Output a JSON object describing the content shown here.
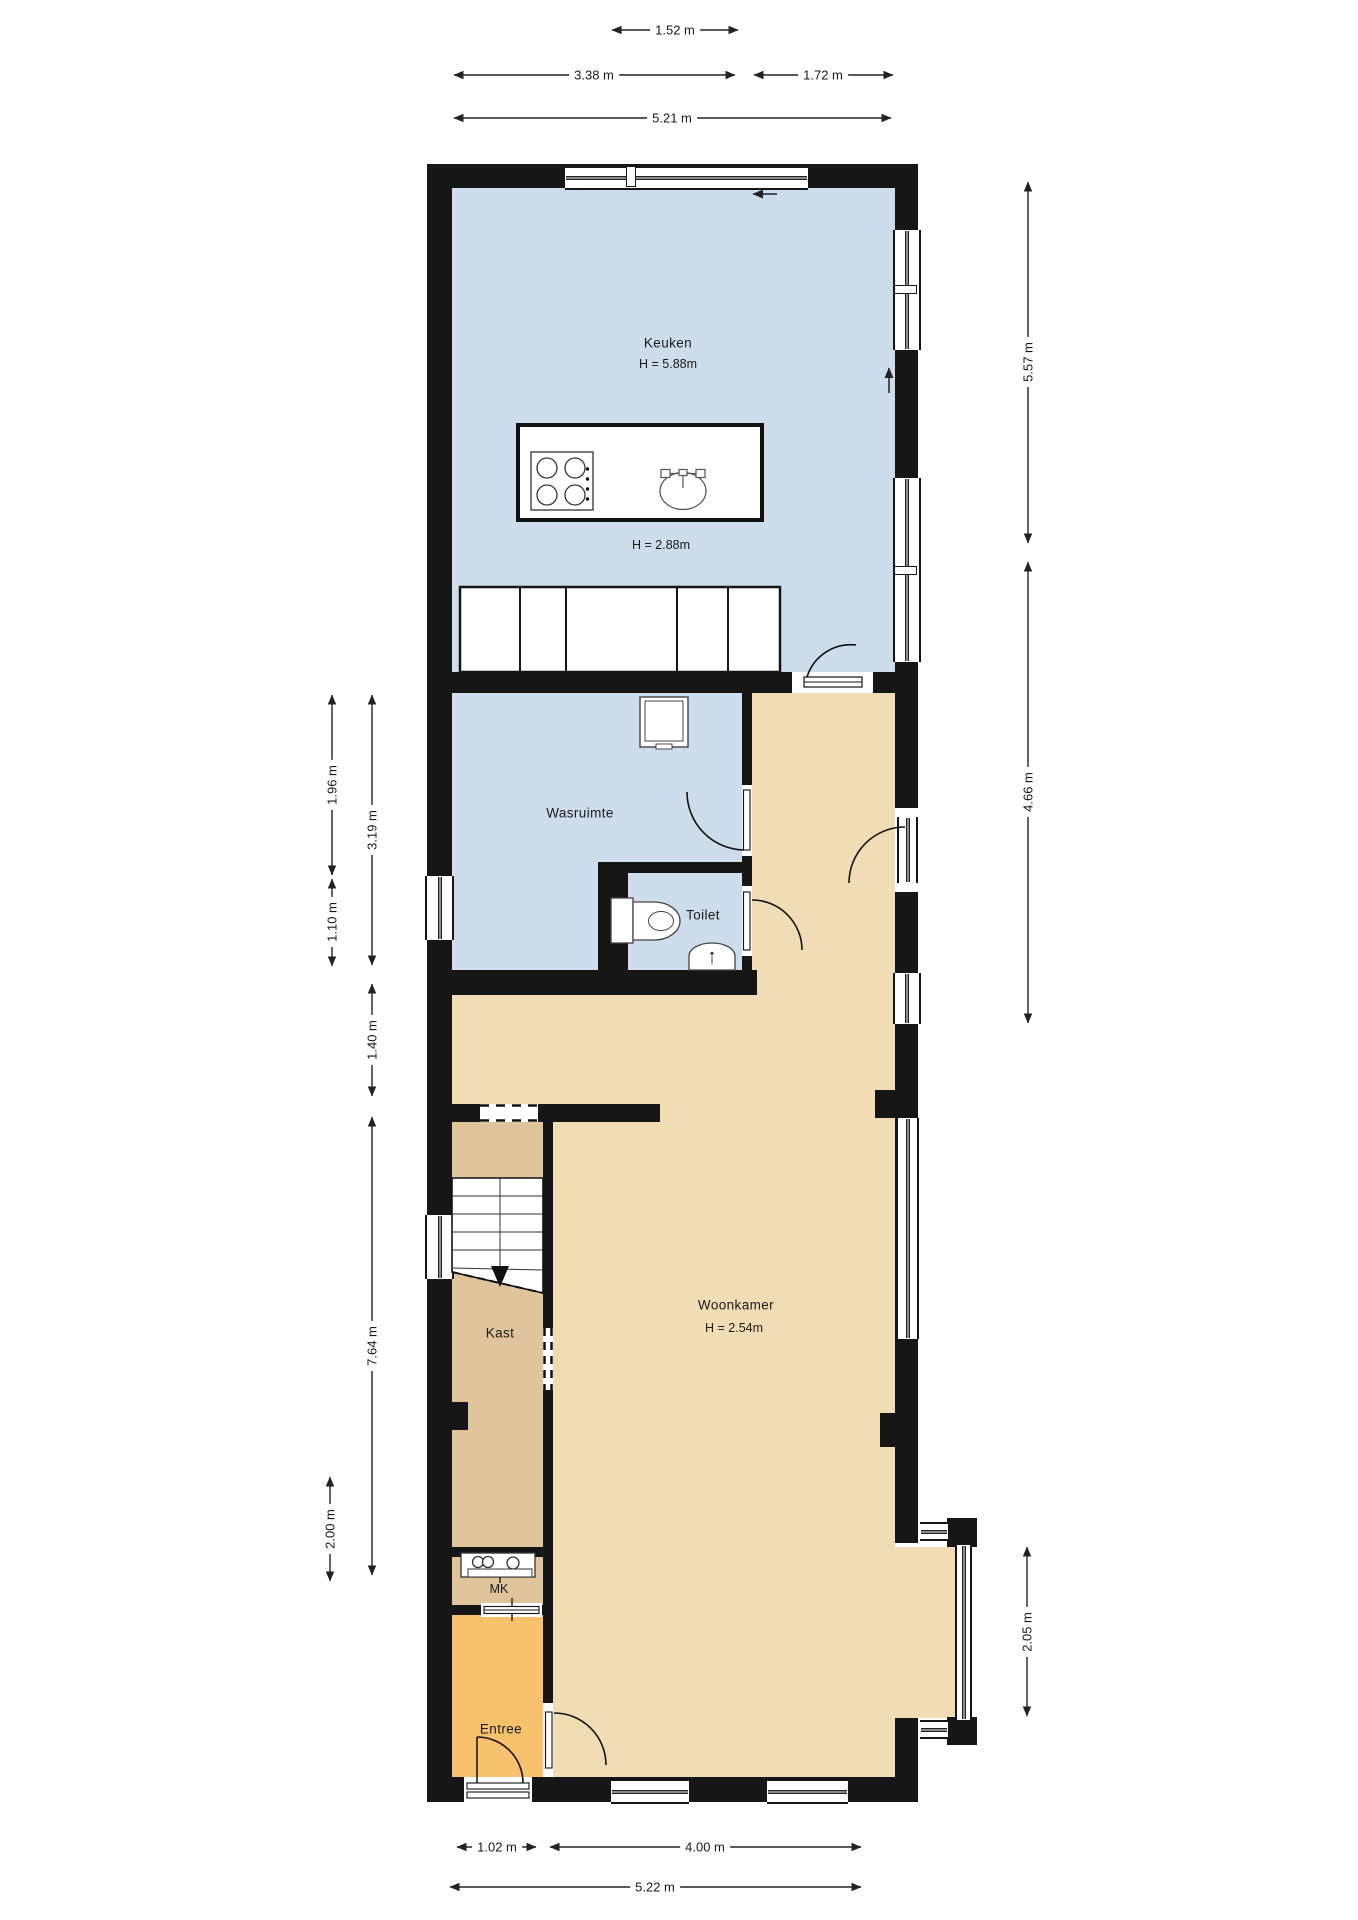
{
  "rooms": {
    "keuken": {
      "label": "Keuken",
      "height_label": "H = 5.88m",
      "height_label_2": "H = 2.88m"
    },
    "wasruimte": {
      "label": "Wasruimte"
    },
    "toilet": {
      "label": "Toilet"
    },
    "woonkamer": {
      "label": "Woonkamer",
      "height_label": "H = 2.54m"
    },
    "kast": {
      "label": "Kast"
    },
    "meterkast": {
      "label": "MK"
    },
    "entree": {
      "label": "Entree"
    }
  },
  "dimensions": {
    "top": [
      {
        "label": "1.52 m"
      },
      {
        "label": "3.38 m"
      },
      {
        "label": "1.72 m"
      },
      {
        "label": "5.21 m"
      }
    ],
    "bottom": [
      {
        "label": "1.02 m"
      },
      {
        "label": "4.00 m"
      },
      {
        "label": "5.22 m"
      }
    ],
    "left": [
      {
        "label": "1.96 m"
      },
      {
        "label": "1.10 m"
      },
      {
        "label": "3.19 m"
      },
      {
        "label": "1.40 m"
      },
      {
        "label": "7.64 m"
      },
      {
        "label": "2.00 m"
      }
    ],
    "right": [
      {
        "label": "5.57 m"
      },
      {
        "label": "4.66 m"
      },
      {
        "label": "2.05 m"
      }
    ]
  },
  "icons": {
    "cooktop": "cooktop-icon",
    "sink": "sink-icon",
    "washing_machine": "washing-machine-icon",
    "toilet": "toilet-icon",
    "hand_basin": "hand-basin-icon",
    "stairs": "stairs-down-icon",
    "meter_board": "meter-board-icon",
    "slide_arrow_left": "slide-arrow-left-icon",
    "slide_arrow_up": "slide-arrow-up-icon"
  },
  "colors": {
    "wall": "#161616",
    "kitchen_fill": "#cdddec",
    "living_fill": "#f1ddb5",
    "closet_fill": "#dfc49c",
    "entry_fill": "#f7c16e",
    "line": "#222222"
  }
}
